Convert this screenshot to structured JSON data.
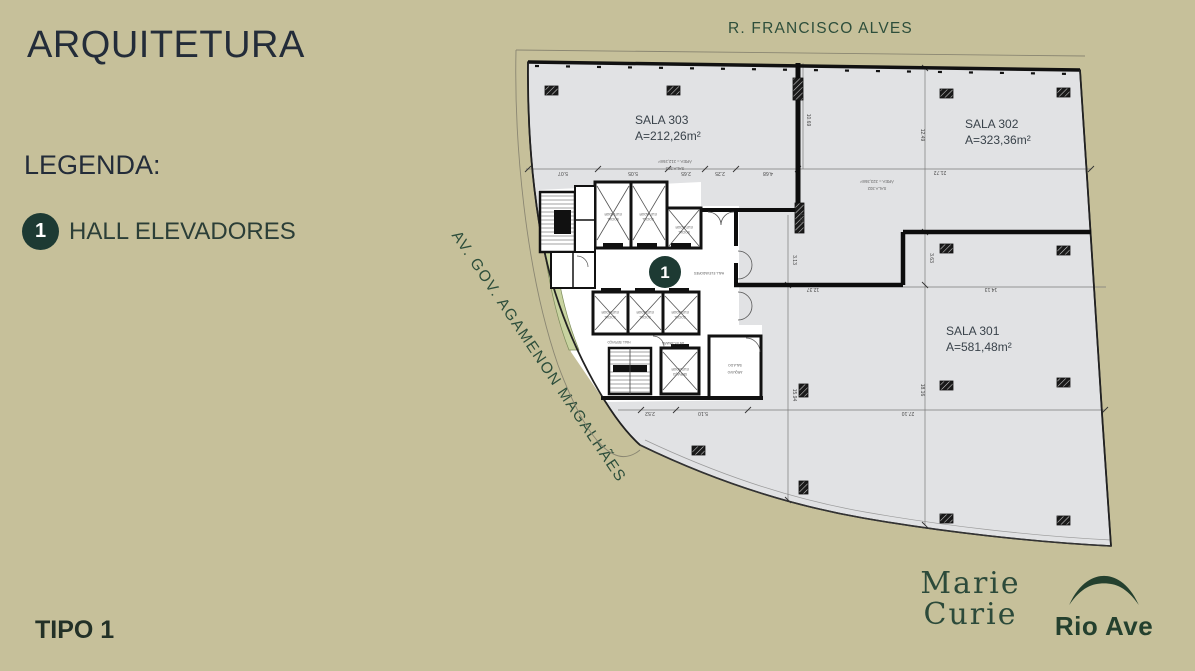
{
  "slide": {
    "title": "ARQUITETURA",
    "legend_title": "LEGENDA:",
    "legend_items": [
      {
        "number": "1",
        "label": "HALL ELEVADORES"
      }
    ],
    "type_label": "TIPO 1"
  },
  "streets": {
    "top": "R. FRANCISCO ALVES",
    "left": "AV. GOV. AGAMENON MAGALHÃES"
  },
  "rooms": [
    {
      "name": "SALA 303",
      "area": "A=212,26m²",
      "mini": "ÁREA = 212,26m²"
    },
    {
      "name": "SALA 302",
      "area": "A=323,36m²",
      "mini": "ÁREA = 323,36m²"
    },
    {
      "name": "SALA 301",
      "area": "A=581,48m²",
      "mini": "ÁREA = 581,48m²"
    }
  ],
  "core": {
    "badge": "1",
    "hall": "HALL ELEVADORES",
    "hall_servico": "HALL SERVIÇO",
    "antecamara": "ANTECÂMARA",
    "elev": "ELEVADOR",
    "social": "SOCIAL",
    "servico": "SERVIÇO",
    "arquivo1": "SALA DO",
    "arquivo2": "ARQUIVO"
  },
  "dims": {
    "d507": "5.07",
    "d505": "5.05",
    "d265": "2.65",
    "d225": "2.25",
    "d468": "4.68",
    "d1069": "10.69",
    "d1249": "12.49",
    "d2172": "21.72",
    "d363": "3.63",
    "d1816": "18.16",
    "d1413": "14.13",
    "d1237": "12.37",
    "d313": "3.13",
    "d195": "1.95",
    "d1594": "15.94",
    "d252": "2.52",
    "d510": "5.10",
    "d2710": "27.10"
  },
  "logos": {
    "marie_line1": "Marie",
    "marie_line2": "Curie",
    "rioave": "Rio Ave"
  },
  "colors": {
    "background": "#c6c09a",
    "accent_green": "#1d3a33",
    "street_green": "#2d4e3b",
    "plan_floor": "#e1e2e4",
    "logo_green": "#24402e"
  }
}
